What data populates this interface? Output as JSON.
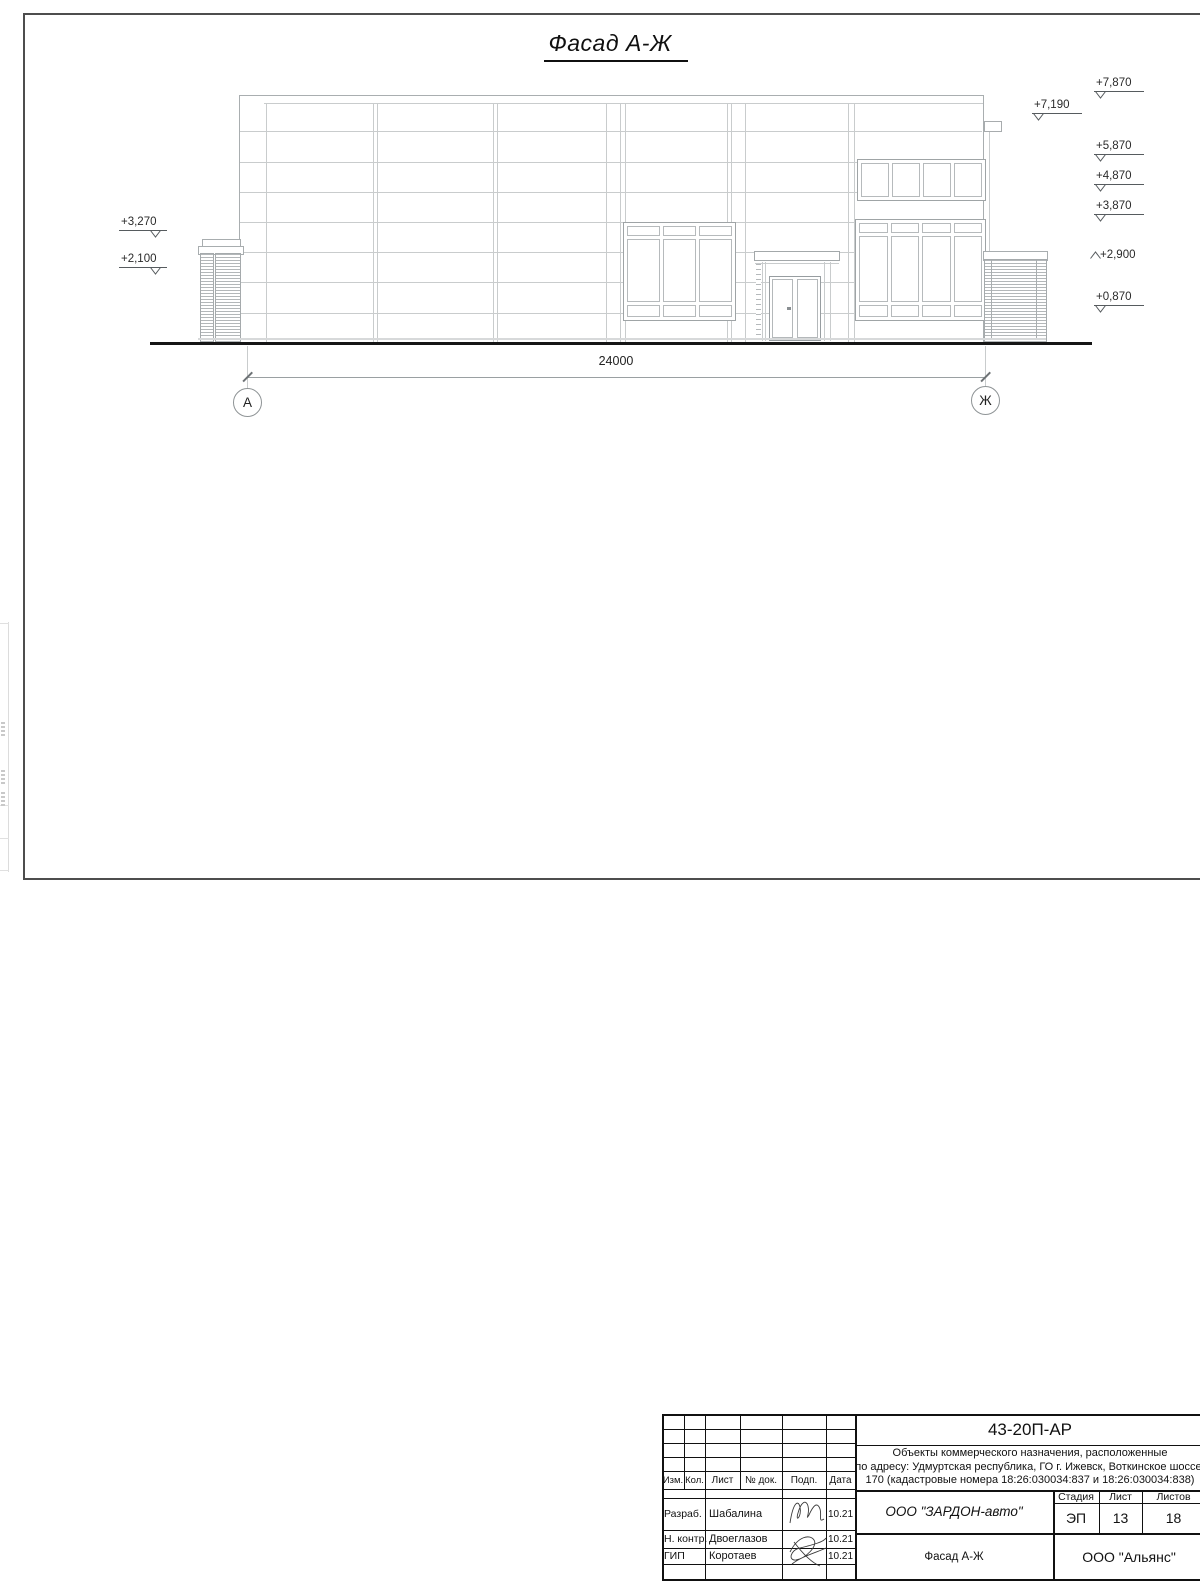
{
  "page": {
    "title": "Фасад А-Ж"
  },
  "drawing": {
    "dimension_label": "24000",
    "axis_left": "А",
    "axis_right": "Ж",
    "elevations_right": [
      {
        "label": "+7,870"
      },
      {
        "label": "+7,190"
      },
      {
        "label": "+5,870"
      },
      {
        "label": "+4,870"
      },
      {
        "label": "+3,870"
      },
      {
        "label": "+2,900"
      },
      {
        "label": "+0,870"
      }
    ],
    "elevations_left": [
      {
        "label": "+3,270"
      },
      {
        "label": "+2,100"
      }
    ]
  },
  "titleblock": {
    "doc_number": "43-20П-АР",
    "description_line1": "Объекты коммерческого назначения, расположенные",
    "description_line2": "по адресу: Удмуртская республика, ГО г. Ижевск, Воткинское шоссе,",
    "description_line3": "170 (кадастровые номера 18:26:030034:837 и 18:26:030034:838)",
    "rev_headers": {
      "izm": "Изм.",
      "kol": "Кол.",
      "list": "Лист",
      "ndok": "№ док.",
      "podp": "Подп.",
      "data": "Дата"
    },
    "signers": [
      {
        "role": "Разраб.",
        "name": "Шабалина",
        "date": "10.21"
      },
      {
        "role": "Н. контр.",
        "name": "Двоеглазов",
        "date": "10.21"
      },
      {
        "role": "ГИП",
        "name": "Коротаев",
        "date": "10.21"
      }
    ],
    "company": "ООО \"ЗАРДОН-авто\"",
    "sheet_name": "Фасад А-Ж",
    "org": "ООО \"Альянс\"",
    "stage_headers": {
      "stage": "Стадия",
      "list": "Лист",
      "listov": "Листов"
    },
    "stage_value": "ЭП",
    "sheet_value": "13",
    "sheets_value": "18"
  }
}
